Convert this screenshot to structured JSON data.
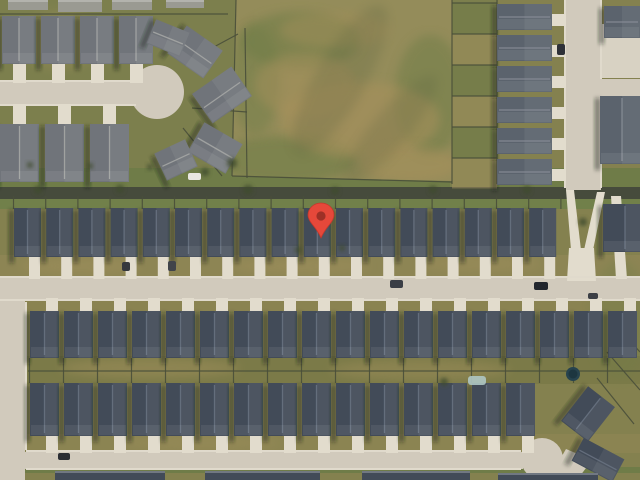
{
  "app": {
    "name": "satellite-map-view",
    "description": "Aerial satellite imagery of a suburban residential neighborhood with a red location marker pin"
  },
  "marker": {
    "x": 321,
    "y": 238,
    "width": 26,
    "height": 34,
    "color": "#E6483A",
    "outline": "#C5372B",
    "dot": "#9E3026"
  },
  "palette": {
    "base": "#84814f",
    "grass": "#7c7f4d",
    "grass_dark": "#6f7c48",
    "grass_low": "#71804a",
    "front_yard": "#8d8554",
    "drive_strip": "#8a8351",
    "backyard": "#7b7a48",
    "yard2": "#8b8452",
    "tan": "#a5935f",
    "field_base": "#948c5a",
    "field_green": "#6e7d46",
    "field_brown": "#a8915c",
    "field_dark": "#56603c",
    "road": "#d1cabc",
    "road_light": "#e0dacc",
    "drive": "#e2dccd",
    "court": "#d8d2c3",
    "alley": "#464b3c",
    "fence": "#4a4f3a",
    "tree": "#3f4c2e",
    "roof_dark": "#424b58",
    "ridge_dark": "#6a7483",
    "roof_mid": "#5b636d",
    "ridge_mid": "#8a9099",
    "roof_light": "#70747a",
    "ridge_light": "#a8a9a7",
    "roof_pale": "#9a9a92",
    "shadow": "rgba(25,30,22,0.5)",
    "pool": "#aec6c4",
    "trampoline": "#27434e"
  },
  "scene": {
    "width": 640,
    "height": 480,
    "zones": [
      {
        "x": 0,
        "y": 0,
        "w": 640,
        "h": 480,
        "fill": "base"
      },
      {
        "x": 0,
        "y": 0,
        "w": 250,
        "h": 188,
        "fill": "grass"
      },
      {
        "x": 0,
        "y": 168,
        "w": 640,
        "h": 20,
        "fill": "grass_dark"
      },
      {
        "x": 0,
        "y": 198,
        "w": 640,
        "h": 11,
        "fill": "grass_low"
      },
      {
        "x": 0,
        "y": 255,
        "w": 640,
        "h": 23,
        "fill": "front_yard"
      },
      {
        "x": 0,
        "y": 296,
        "w": 640,
        "h": 15,
        "fill": "drive_strip"
      },
      {
        "x": 27,
        "y": 356,
        "w": 613,
        "h": 28,
        "fill": "backyard"
      },
      {
        "x": 27,
        "y": 434,
        "w": 613,
        "h": 19,
        "fill": "yard2"
      },
      {
        "x": 0,
        "y": 467,
        "w": 640,
        "h": 6,
        "fill": "grass_dark"
      },
      {
        "x": 450,
        "y": 0,
        "w": 48,
        "h": 190,
        "fill": "grass"
      }
    ],
    "field": {
      "points": "236,0 452,0 452,181 232,176",
      "mottles": [
        {
          "cx": 300,
          "cy": 40,
          "rx": 60,
          "ry": 28,
          "fill": "field_green",
          "o": 0.55
        },
        {
          "cx": 430,
          "cy": 95,
          "rx": 35,
          "ry": 60,
          "fill": "field_green",
          "o": 0.5
        },
        {
          "cx": 285,
          "cy": 160,
          "rx": 70,
          "ry": 24,
          "fill": "field_green",
          "o": 0.6
        },
        {
          "cx": 255,
          "cy": 80,
          "rx": 25,
          "ry": 55,
          "fill": "field_green",
          "o": 0.45
        },
        {
          "cx": 360,
          "cy": 120,
          "rx": 80,
          "ry": 38,
          "fill": "field_brown",
          "o": 0.55
        },
        {
          "cx": 305,
          "cy": 85,
          "rx": 50,
          "ry": 32,
          "fill": "field_brown",
          "o": 0.45
        },
        {
          "cx": 410,
          "cy": 165,
          "rx": 50,
          "ry": 18,
          "fill": "field_brown",
          "o": 0.5
        },
        {
          "cx": 335,
          "cy": 30,
          "rx": 55,
          "ry": 18,
          "fill": "field_brown",
          "o": 0.4
        },
        {
          "cx": 340,
          "cy": 80,
          "rx": 25,
          "ry": 85,
          "fill": "field_dark",
          "o": 0.22,
          "rot": 30
        },
        {
          "cx": 390,
          "cy": 130,
          "rx": 18,
          "ry": 70,
          "fill": "field_dark",
          "o": 0.2,
          "rot": 40
        }
      ]
    },
    "patches": [
      {
        "cx": 80,
        "cy": 266,
        "rx": 60,
        "ry": 8,
        "fill": "tan",
        "o": 0.4
      },
      {
        "cx": 300,
        "cy": 266,
        "rx": 70,
        "ry": 8,
        "fill": "tan",
        "o": 0.4
      },
      {
        "cx": 480,
        "cy": 264,
        "rx": 60,
        "ry": 8,
        "fill": "tan",
        "o": 0.35
      },
      {
        "cx": 150,
        "cy": 368,
        "rx": 90,
        "ry": 10,
        "fill": "tan",
        "o": 0.45
      },
      {
        "cx": 420,
        "cy": 370,
        "rx": 90,
        "ry": 10,
        "fill": "tan",
        "o": 0.4
      },
      {
        "cx": 200,
        "cy": 443,
        "rx": 80,
        "ry": 7,
        "fill": "tan",
        "o": 0.35
      },
      {
        "cx": 60,
        "cy": 40,
        "rx": 40,
        "ry": 30,
        "fill": "tan",
        "o": 0.25
      },
      {
        "cx": 620,
        "cy": 320,
        "rx": 30,
        "ry": 60,
        "fill": "field_green",
        "o": 0.3
      }
    ],
    "roads": {
      "rects": [
        {
          "x": 0,
          "y": 82,
          "w": 138,
          "h": 23
        },
        {
          "x": 566,
          "y": 0,
          "w": 35,
          "h": 190
        },
        {
          "x": 598,
          "y": 79,
          "w": 42,
          "h": 22
        },
        {
          "x": 0,
          "y": 278,
          "w": 640,
          "h": 22
        },
        {
          "x": 0,
          "y": 290,
          "w": 25,
          "h": 190
        },
        {
          "x": 8,
          "y": 452,
          "w": 515,
          "h": 17
        },
        {
          "x": 602,
          "y": 24,
          "w": 38,
          "h": 54,
          "fill": "court"
        }
      ],
      "circles": [
        {
          "cx": 157,
          "cy": 92,
          "r": 27
        },
        {
          "cx": 542,
          "cy": 459,
          "r": 21
        }
      ],
      "polys": [
        {
          "points": "552,473 566,449 592,460 577,480"
        },
        {
          "points": "566,190 574,190 581,250 571,250",
          "fill": "drive"
        },
        {
          "points": "597,192 605,192 593,250 584,250",
          "fill": "drive"
        },
        {
          "points": "569,248 594,248 596,281 567,281",
          "fill": "drive"
        },
        {
          "points": "611,196 621,196 627,279 616,279",
          "fill": "drive"
        }
      ],
      "sidewalks": [
        {
          "x1": 0,
          "y1": 277,
          "x2": 640,
          "y2": 277
        },
        {
          "x1": 0,
          "y1": 300,
          "x2": 640,
          "y2": 300
        },
        {
          "x1": 26,
          "y1": 302,
          "x2": 26,
          "y2": 450
        },
        {
          "x1": 26,
          "y1": 451,
          "x2": 521,
          "y2": 451
        },
        {
          "x1": 26,
          "y1": 469,
          "x2": 521,
          "y2": 469
        },
        {
          "x1": 565,
          "y1": 0,
          "x2": 565,
          "y2": 188
        },
        {
          "x1": 601,
          "y1": 0,
          "x2": 601,
          "y2": 79
        },
        {
          "x1": 601,
          "y1": 101,
          "x2": 601,
          "y2": 188
        },
        {
          "x1": 0,
          "y1": 81,
          "x2": 136,
          "y2": 81
        },
        {
          "x1": 0,
          "y1": 105,
          "x2": 136,
          "y2": 105
        }
      ]
    },
    "fence_sets": [
      {
        "x0": 13.5,
        "spacing": 32.2,
        "count": 18,
        "y1": 196,
        "y2": 209
      },
      {
        "x0": 29.5,
        "spacing": 34,
        "count": 19,
        "y1": 358,
        "y2": 383
      },
      {
        "horizontal": true,
        "y0": 3,
        "spacing": 31,
        "count": 7,
        "x1": 452,
        "x2": 497
      }
    ],
    "fence_lines": [
      {
        "x1": 28,
        "y1": 371,
        "x2": 640,
        "y2": 371
      },
      {
        "x1": 452,
        "y1": 0,
        "x2": 452,
        "y2": 184
      },
      {
        "x1": 497,
        "y1": 0,
        "x2": 497,
        "y2": 184
      },
      {
        "x1": 236,
        "y1": 0,
        "x2": 232,
        "y2": 176
      },
      {
        "x1": 232,
        "y1": 176,
        "x2": 452,
        "y2": 182
      },
      {
        "x1": 607,
        "y1": 352,
        "x2": 640,
        "y2": 390
      },
      {
        "x1": 597,
        "y1": 378,
        "x2": 634,
        "y2": 424
      },
      {
        "x1": 620,
        "y1": 330,
        "x2": 640,
        "y2": 352
      },
      {
        "x1": 186,
        "y1": 62,
        "x2": 238,
        "y2": 34
      },
      {
        "x1": 192,
        "y1": 108,
        "x2": 247,
        "y2": 112
      },
      {
        "x1": 183,
        "y1": 128,
        "x2": 222,
        "y2": 176
      },
      {
        "x1": 245,
        "y1": 28,
        "x2": 247,
        "y2": 178
      },
      {
        "x1": 0,
        "y1": 14,
        "x2": 228,
        "y2": 14
      }
    ],
    "cells": {
      "x": 452,
      "y0": 3,
      "w": 45,
      "spacing": 31,
      "count": 6
    },
    "drive_sets": [
      {
        "x0": 14,
        "dx": 15,
        "spacing": 32.2,
        "count": 17,
        "y": 257,
        "w": 11,
        "h": 22
      },
      {
        "x0": 30,
        "dx": 16,
        "spacing": 34,
        "count": 18,
        "y": 298,
        "w": 12,
        "h": 14
      },
      {
        "x0": 30,
        "dx": 16,
        "spacing": 34,
        "count": 15,
        "y": 436,
        "w": 12,
        "h": 17
      },
      {
        "x0": 2,
        "dx": 11,
        "spacing": 39,
        "count": 4,
        "y": 64,
        "w": 13,
        "h": 19
      },
      {
        "x0": 0,
        "dx": 13,
        "spacing": 45,
        "count": 3,
        "y": 104,
        "w": 13,
        "h": 20
      },
      {
        "vertical": true,
        "y0": 4,
        "dy": 10,
        "spacing": 31,
        "count": 6,
        "x": 550,
        "w": 16,
        "h": 12
      }
    ],
    "rows": [
      {
        "name": "middle-row",
        "x0": 14,
        "spacing": 32.2,
        "count": 17,
        "w": 27,
        "y": 208,
        "h": 49,
        "style": "dark"
      },
      {
        "name": "bottom-row-upper",
        "x0": 30,
        "spacing": 34,
        "count": 18,
        "w": 29,
        "y": 311,
        "h": 47,
        "style": "dark"
      },
      {
        "name": "bottom-row-lower",
        "x0": 30,
        "spacing": 34,
        "count": 15,
        "w": 29,
        "y": 383,
        "h": 53,
        "style": "dark"
      },
      {
        "name": "culdesac-row-upper",
        "x0": 2,
        "spacing": 39,
        "count": 4,
        "w": 34,
        "y": 16,
        "h": 48,
        "style": "light"
      },
      {
        "name": "culdesac-row-lower",
        "x0": 0,
        "spacing": 45,
        "count": 3,
        "w": 39,
        "y": 124,
        "h": 58,
        "style": "light"
      }
    ],
    "column": {
      "x": 497,
      "w": 55,
      "y0": 4,
      "spacing": 31,
      "count": 6,
      "h": 26,
      "style": "mid"
    },
    "rotated": [
      {
        "cx": 195,
        "cy": 52,
        "w": 44,
        "h": 34,
        "rot": 35,
        "style": "light"
      },
      {
        "cx": 168,
        "cy": 38,
        "w": 36,
        "h": 26,
        "rot": 22,
        "style": "light"
      },
      {
        "cx": 222,
        "cy": 95,
        "w": 48,
        "h": 36,
        "rot": -35,
        "style": "light"
      },
      {
        "cx": 215,
        "cy": 148,
        "w": 44,
        "h": 34,
        "rot": 30,
        "style": "light"
      },
      {
        "cx": 176,
        "cy": 160,
        "w": 34,
        "h": 30,
        "rot": -25,
        "style": "light"
      },
      {
        "cx": 588,
        "cy": 414,
        "w": 34,
        "h": 44,
        "rot": 38,
        "style": "dark"
      },
      {
        "cx": 598,
        "cy": 460,
        "w": 46,
        "h": 26,
        "rot": 28,
        "style": "dark"
      },
      {
        "cx": 625,
        "cy": 228,
        "w": 44,
        "h": 48,
        "rot": 0,
        "style": "dark"
      },
      {
        "cx": 622,
        "cy": 130,
        "w": 44,
        "h": 68,
        "rot": 0,
        "style": "mid"
      },
      {
        "cx": 622,
        "cy": 22,
        "w": 36,
        "h": 32,
        "rot": 0,
        "style": "mid"
      }
    ],
    "partial_roofs": [
      {
        "x": 55,
        "y": 471,
        "w": 110,
        "h": 9
      },
      {
        "x": 205,
        "y": 471,
        "w": 115,
        "h": 9
      },
      {
        "x": 362,
        "y": 471,
        "w": 108,
        "h": 9
      },
      {
        "x": 498,
        "y": 473,
        "w": 100,
        "h": 7
      },
      {
        "x": 8,
        "y": 0,
        "w": 40,
        "h": 10,
        "style": "pale"
      },
      {
        "x": 58,
        "y": 0,
        "w": 44,
        "h": 12,
        "style": "pale"
      },
      {
        "x": 112,
        "y": 0,
        "w": 40,
        "h": 10,
        "style": "pale"
      },
      {
        "x": 166,
        "y": 0,
        "w": 38,
        "h": 8,
        "style": "pale"
      }
    ],
    "trees": [
      {
        "cx": 248,
        "cy": 190,
        "r": 5
      },
      {
        "cx": 120,
        "cy": 189,
        "r": 4
      },
      {
        "cx": 38,
        "cy": 190,
        "r": 4
      },
      {
        "cx": 335,
        "cy": 191,
        "r": 4
      },
      {
        "cx": 433,
        "cy": 190,
        "r": 4
      },
      {
        "cx": 527,
        "cy": 190,
        "r": 4
      },
      {
        "cx": 583,
        "cy": 222,
        "r": 4
      },
      {
        "cx": 205,
        "cy": 172,
        "r": 4
      },
      {
        "cx": 232,
        "cy": 163,
        "r": 5
      },
      {
        "cx": 298,
        "cy": 250,
        "r": 3
      },
      {
        "cx": 342,
        "cy": 248,
        "r": 3
      },
      {
        "cx": 30,
        "cy": 165,
        "r": 3
      },
      {
        "cx": 90,
        "cy": 166,
        "r": 3
      },
      {
        "cx": 150,
        "cy": 167,
        "r": 3
      },
      {
        "cx": 444,
        "cy": 382,
        "r": 4
      },
      {
        "cx": 760,
        "cy": 0,
        "r": 0
      }
    ],
    "pool": {
      "x": 468,
      "y": 376,
      "w": 18,
      "h": 9
    },
    "trampoline": {
      "cx": 573,
      "cy": 374,
      "r": 7
    },
    "cars": [
      {
        "x": 390,
        "y": 280,
        "w": 13,
        "h": 8,
        "fill": "#3a3e45"
      },
      {
        "x": 534,
        "y": 282,
        "w": 14,
        "h": 8,
        "fill": "#22262d"
      },
      {
        "x": 58,
        "y": 453,
        "w": 12,
        "h": 7,
        "fill": "#2b2e33"
      },
      {
        "x": 168,
        "y": 261,
        "w": 8,
        "h": 10,
        "fill": "#40444a"
      },
      {
        "x": 122,
        "y": 262,
        "w": 8,
        "h": 9,
        "fill": "#35383d"
      },
      {
        "x": 188,
        "y": 173,
        "w": 13,
        "h": 7,
        "fill": "#e9e7e1"
      },
      {
        "x": 557,
        "y": 44,
        "w": 8,
        "h": 11,
        "fill": "#2e3138"
      },
      {
        "x": 588,
        "y": 293,
        "w": 10,
        "h": 6,
        "fill": "#3c3f45"
      }
    ]
  }
}
